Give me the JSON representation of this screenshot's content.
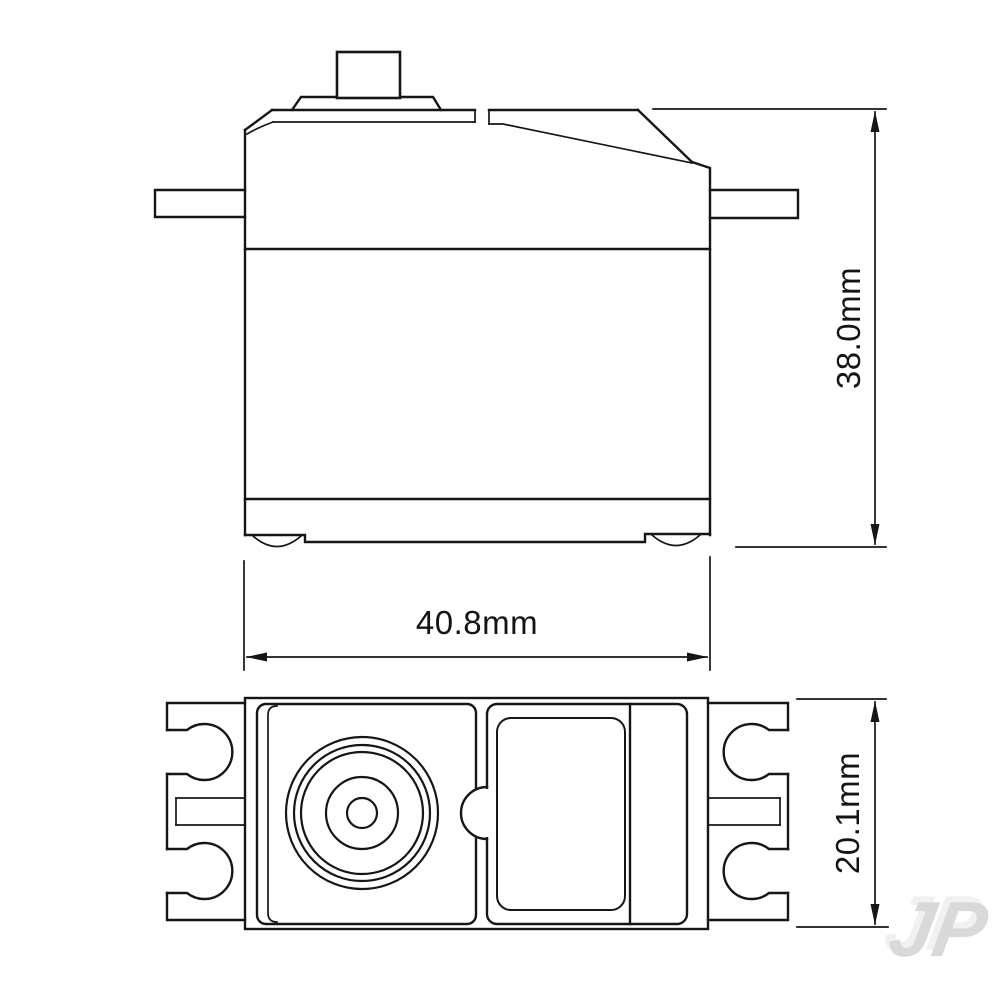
{
  "drawing": {
    "type": "technical-dimension-drawing",
    "subject": "servo",
    "views": {
      "side_view": {
        "label": "side elevation"
      },
      "top_view": {
        "label": "plan view"
      }
    },
    "dimensions": {
      "body_width": "40.8mm",
      "body_height": "38.0mm",
      "body_depth": "20.1mm"
    },
    "watermark": "JP",
    "colors": {
      "line": "#161616",
      "background": "#ffffff",
      "watermark": "#d9d9d9",
      "watermark_echo": "#f1f1f1"
    }
  }
}
